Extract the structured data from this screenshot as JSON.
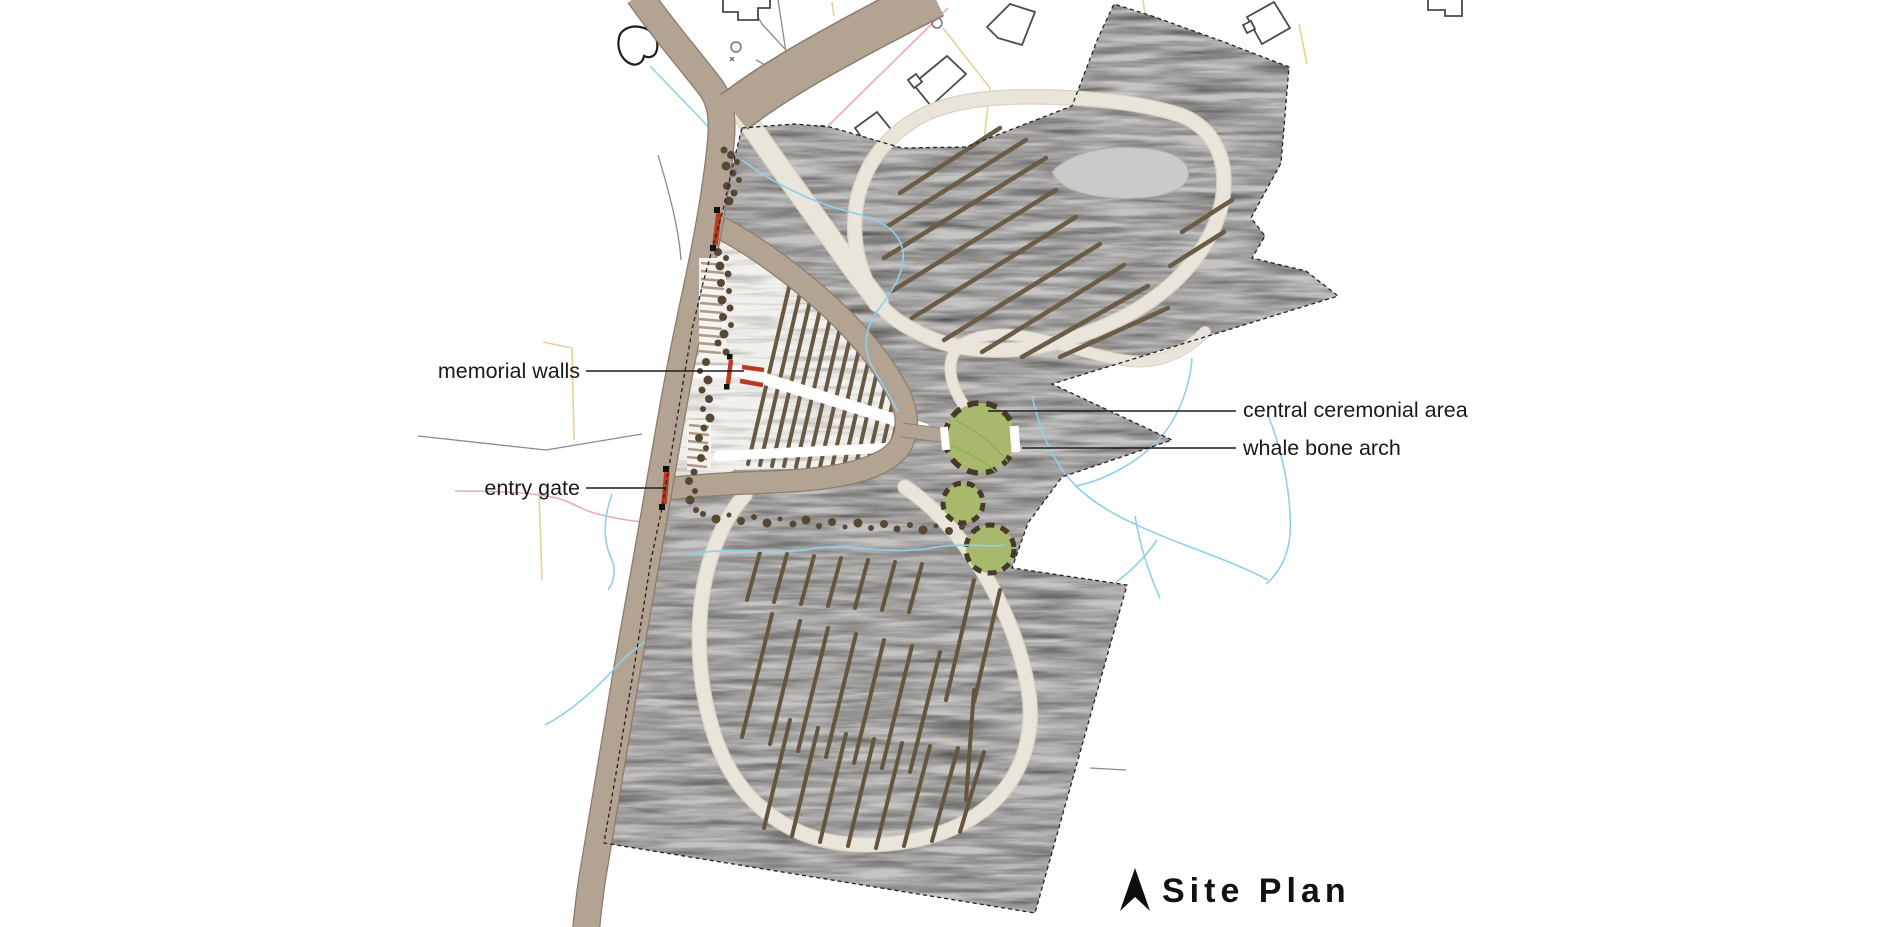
{
  "title": {
    "label": "Site Plan"
  },
  "annotations": {
    "memorial_walls": "memorial walls",
    "entry_gate": "entry gate",
    "central_ceremonial_area": "central ceremonial area",
    "whale_bone_arch": "whale bone arch"
  },
  "icons": {
    "north_arrow": "north-arrow"
  },
  "colors": {
    "road_tan": "#b3a392",
    "road_edge": "#8a7b6a",
    "walking_path_cream": "#eae5db",
    "ground_gray": "#c5c4c2",
    "burial_row_brown": "#63563f",
    "ceremonial_green": "#a8b86d",
    "circle_border_brown": "#463b28",
    "structure_red": "#b73b20",
    "stream_blue": "#8fd0ee",
    "parcel_pink": "#f0a8bd",
    "parcel_yellow": "#e7d193",
    "building_outline": "#4a4a4a",
    "boundary_black": "#222222",
    "label_text": "#1a1a1a"
  }
}
